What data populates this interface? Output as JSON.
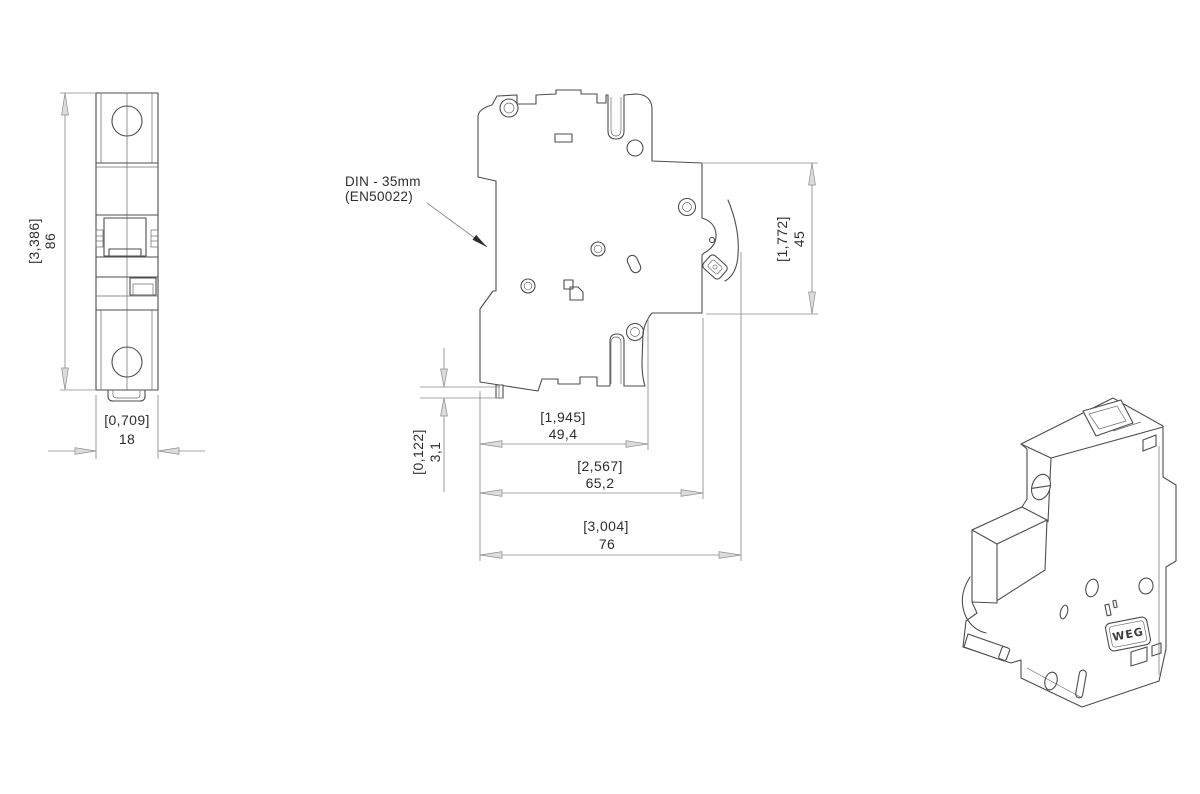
{
  "dimensions": {
    "front_height": {
      "inch": "[3,386]",
      "mm": "86"
    },
    "front_width": {
      "inch": "[0,709]",
      "mm": "18"
    },
    "side_depth_front": {
      "inch": "[1,945]",
      "mm": "49,4"
    },
    "side_depth_body": {
      "inch": "[2,567]",
      "mm": "65,2"
    },
    "side_depth_total": {
      "inch": "[3,004]",
      "mm": "76"
    },
    "side_height_panel": {
      "inch": "[1,772]",
      "mm": "45"
    },
    "side_clip_tab": {
      "inch": "[0,122]",
      "mm": "3,1"
    }
  },
  "annotations": {
    "din_rail": {
      "line1": "DIN - 35mm",
      "line2": "(EN50022)"
    }
  },
  "logo": {
    "text": "WEG"
  },
  "colors": {
    "background": "#ffffff",
    "part_line": "#4d4d4d",
    "dimension_line": "#8a8a8a",
    "text": "#2e2e31",
    "arrow_fill": "#dcdcdc"
  }
}
